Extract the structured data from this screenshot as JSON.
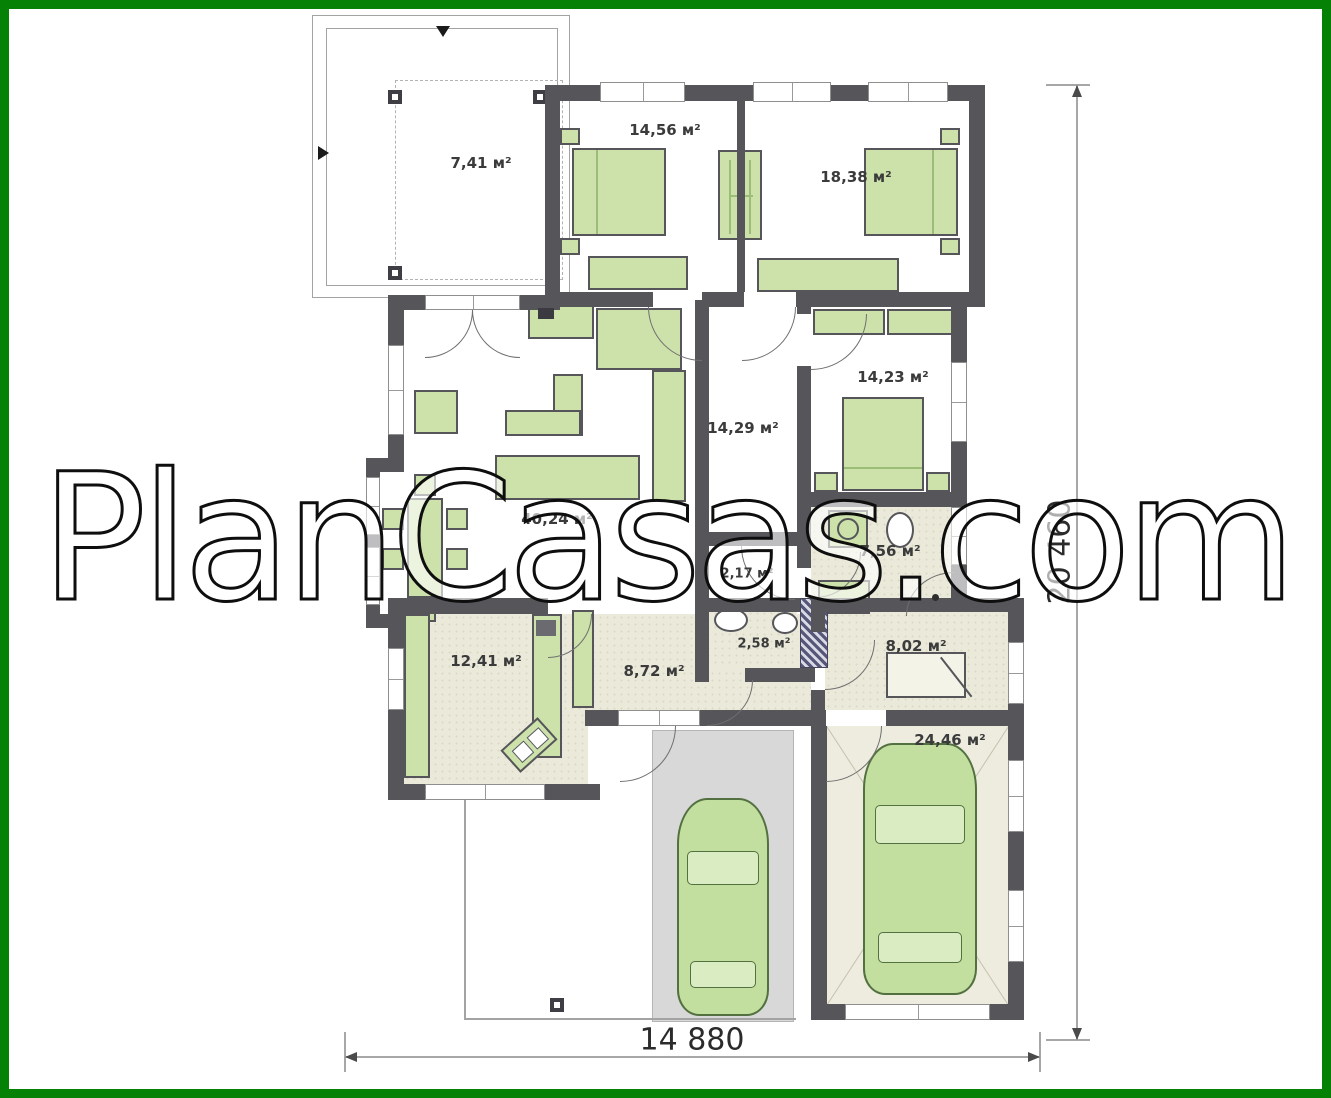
{
  "watermark": {
    "text": "PlanCasas.com"
  },
  "rooms": [
    {
      "name": "terrace",
      "label": "7,41 м²"
    },
    {
      "name": "bedroom-left",
      "label": "14,56 м²"
    },
    {
      "name": "bedroom-right",
      "label": "18,38 м²"
    },
    {
      "name": "bedroom-back",
      "label": "14,23 м²"
    },
    {
      "name": "hall",
      "label": "14,29 м²"
    },
    {
      "name": "living-room",
      "label": "40,24 м²"
    },
    {
      "name": "vestibule",
      "label": "2,17 м²"
    },
    {
      "name": "bathroom",
      "label": "7,56 м²"
    },
    {
      "name": "wc",
      "label": "2,58 м²"
    },
    {
      "name": "kitchen",
      "label": "12,41 м²"
    },
    {
      "name": "corridor",
      "label": "8,72 м²"
    },
    {
      "name": "utility",
      "label": "8,02 м²"
    },
    {
      "name": "garage",
      "label": "24,46 м²"
    }
  ],
  "dimensions": {
    "width_label": "14 880",
    "height_label": "20 460"
  },
  "colors": {
    "frame_green": "#058205",
    "wall": "#56555a",
    "furniture_green": "#cde2aa",
    "floor_beige": "#eae9da",
    "driveway_gray": "#d8d8d8"
  }
}
